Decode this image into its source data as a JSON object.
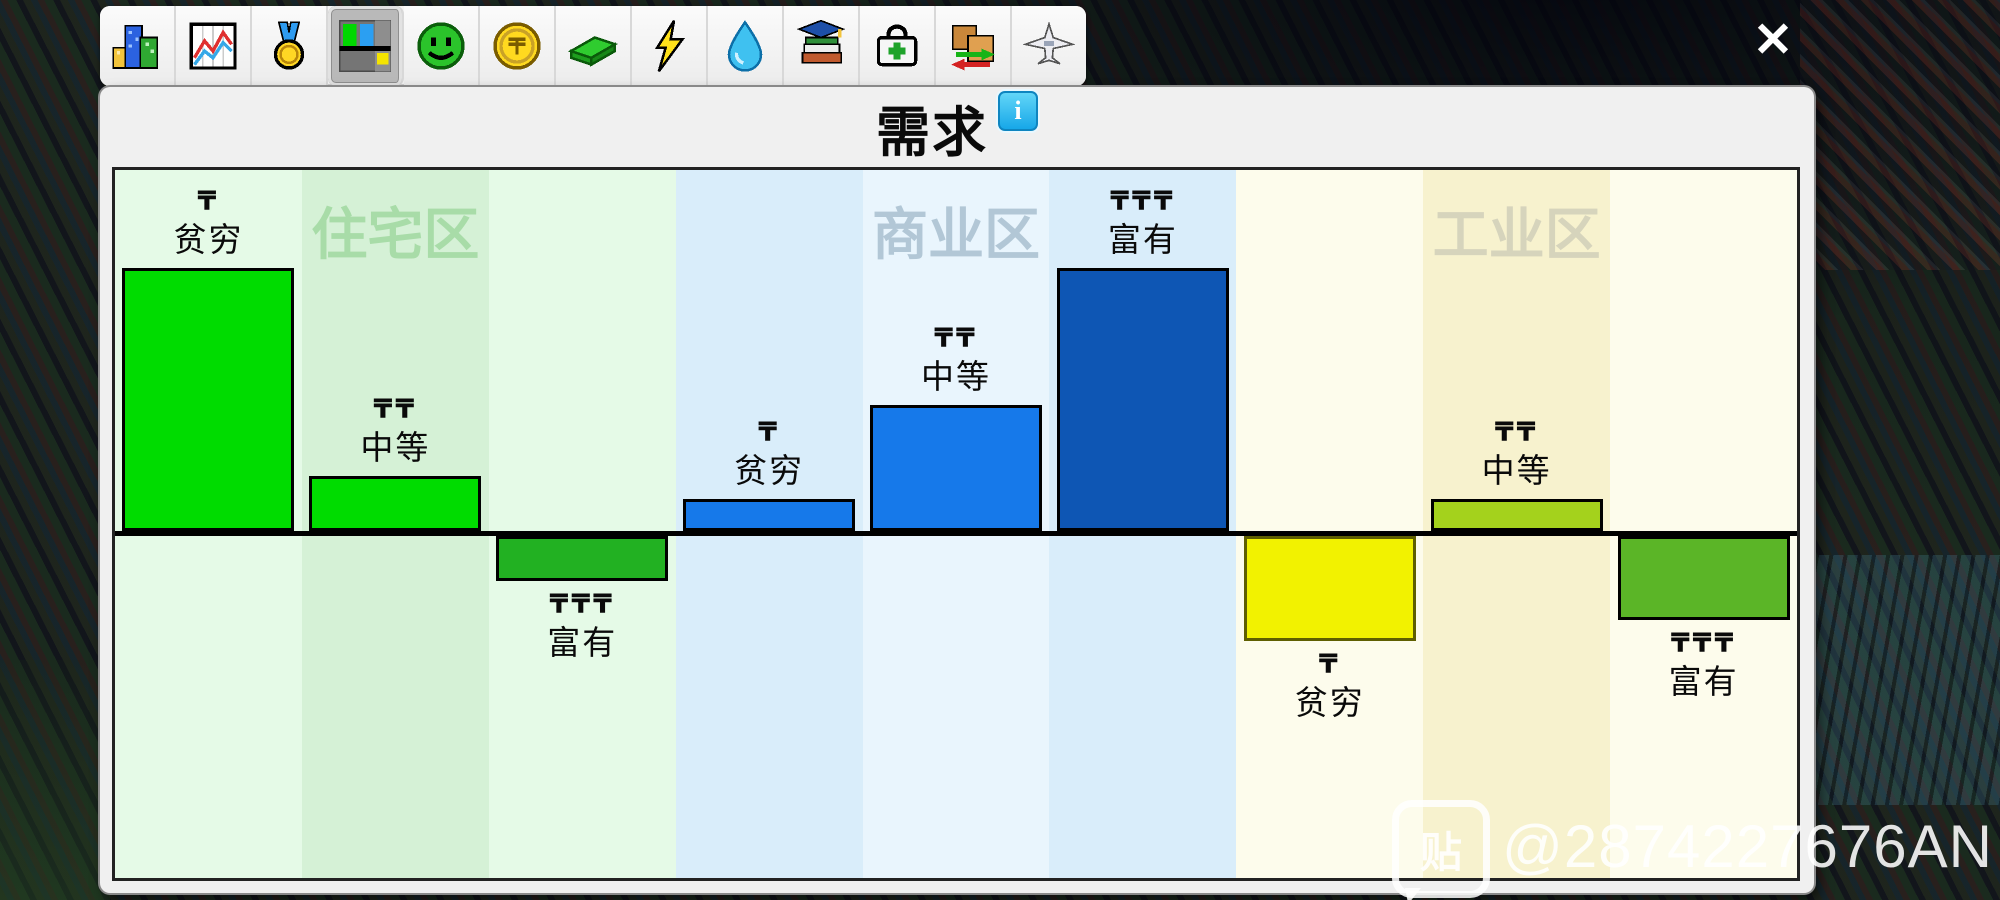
{
  "toolbar": {
    "buttons": [
      {
        "icon": "city-icon",
        "selected": false
      },
      {
        "icon": "statistics-icon",
        "selected": false
      },
      {
        "icon": "rating-medal-icon",
        "selected": false
      },
      {
        "icon": "demand-icon",
        "selected": true
      },
      {
        "icon": "happiness-icon",
        "selected": false
      },
      {
        "icon": "money-coin-icon",
        "selected": false
      },
      {
        "icon": "budget-cash-icon",
        "selected": false
      },
      {
        "icon": "electricity-icon",
        "selected": false
      },
      {
        "icon": "water-icon",
        "selected": false
      },
      {
        "icon": "education-icon",
        "selected": false
      },
      {
        "icon": "health-icon",
        "selected": false
      },
      {
        "icon": "trade-icon",
        "selected": false
      },
      {
        "icon": "airport-icon",
        "selected": false
      }
    ]
  },
  "dialog": {
    "title": "需求",
    "info_icon_label": "i",
    "close_label": "✕"
  },
  "chart_data": {
    "type": "bar",
    "title": "需求",
    "baseline": 0,
    "value_range": [
      -100,
      100
    ],
    "unit": "relative demand, % of tallest bar; negative = below zero line",
    "zones": [
      {
        "label": "住宅区",
        "label_color": "#A8DCA8",
        "stripe_colors": [
          "#E5FAE7",
          "#D5F1D6",
          "#E5FAE7"
        ],
        "bars": [
          {
            "wealth": "贫穷",
            "currency_marks": "₸",
            "value": 100,
            "color": "#00DC00",
            "border_color": "#000000"
          },
          {
            "wealth": "中等",
            "currency_marks": "₸₸",
            "value": 21,
            "color": "#00DC00",
            "border_color": "#000000"
          },
          {
            "wealth": "富有",
            "currency_marks": "₸₸₸",
            "value": -17,
            "color": "#22B122",
            "border_color": "#000000"
          }
        ]
      },
      {
        "label": "商业区",
        "label_color": "#B2C7D6",
        "stripe_colors": [
          "#D9EDFA",
          "#E9F5FD",
          "#D9EDFA"
        ],
        "bars": [
          {
            "wealth": "贫穷",
            "currency_marks": "₸",
            "value": 12,
            "color": "#1679EA",
            "border_color": "#000000"
          },
          {
            "wealth": "中等",
            "currency_marks": "₸₸",
            "value": 48,
            "color": "#1679EA",
            "border_color": "#000000"
          },
          {
            "wealth": "富有",
            "currency_marks": "₸₸₸",
            "value": 100,
            "color": "#0E56B4",
            "border_color": "#000000"
          }
        ]
      },
      {
        "label": "工业区",
        "label_color": "#D6D4BC",
        "stripe_colors": [
          "#FDFCEC",
          "#F7F2CE",
          "#FDFCEC"
        ],
        "bars": [
          {
            "wealth": "贫穷",
            "currency_marks": "₸",
            "value": -40,
            "color": "#F2F200",
            "border_color": "#5F5F00"
          },
          {
            "wealth": "中等",
            "currency_marks": "₸₸",
            "value": 12,
            "color": "#A4D21C",
            "border_color": "#000000"
          },
          {
            "wealth": "富有",
            "currency_marks": "₸₸₸",
            "value": -32,
            "color": "#5BB527",
            "border_color": "#000000"
          }
        ]
      }
    ]
  },
  "watermark": {
    "badge_text": "贴",
    "handle": "@2874227676AN"
  }
}
